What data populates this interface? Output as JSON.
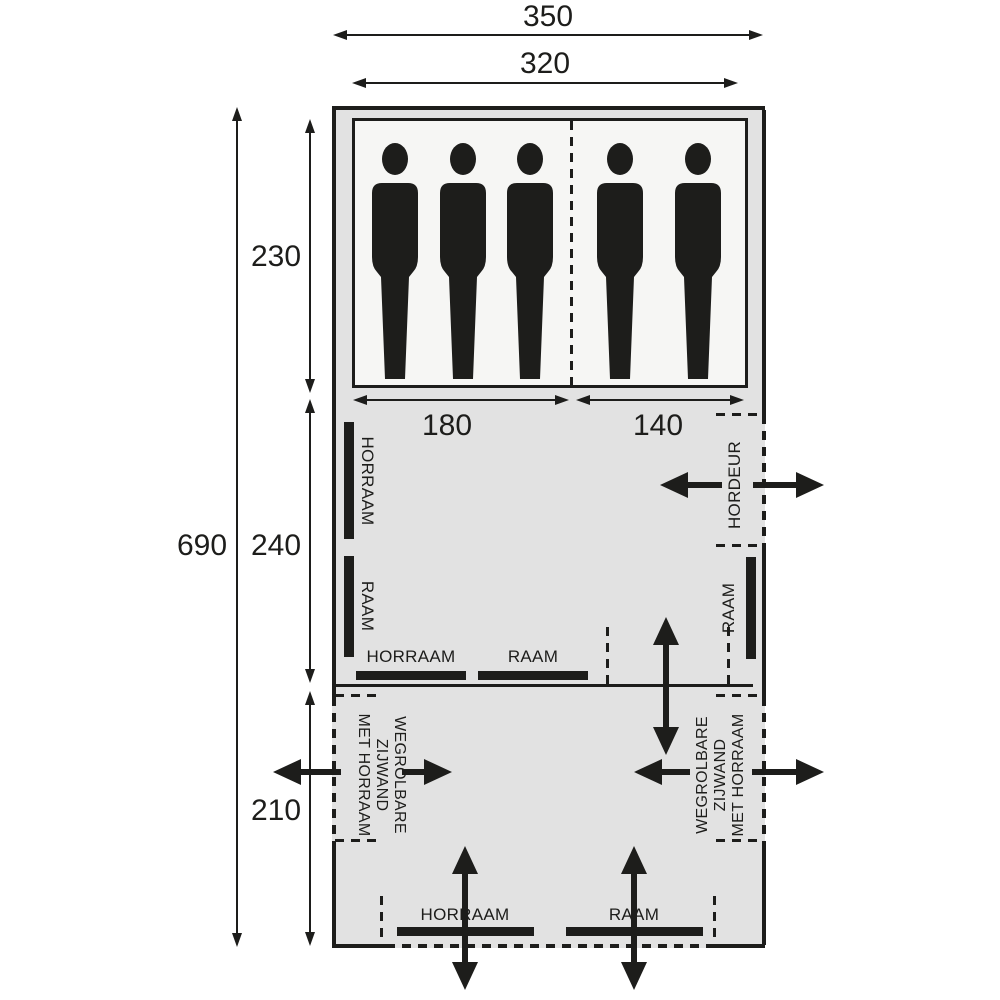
{
  "dimensions": {
    "outer_width": "350",
    "inner_width": "320",
    "total_depth": "690",
    "sleeping_depth": "230",
    "living_depth": "240",
    "awning_depth": "210",
    "bed_left_width": "180",
    "bed_right_width": "140"
  },
  "labels": {
    "horraam": "HORRAAM",
    "raam": "RAAM",
    "hordeur": "HORDEUR",
    "rollaway_line1": "WEGROLBARE",
    "rollaway_line2": "ZIJWAND",
    "rollaway_line3": "MET HORRAAM"
  },
  "sleeping": {
    "left_person_count": 3,
    "right_person_count": 2
  },
  "colors": {
    "ink": "#1d1d1b",
    "tent_fill": "#e2e2e2",
    "cabin_fill": "#f6f6f4"
  }
}
